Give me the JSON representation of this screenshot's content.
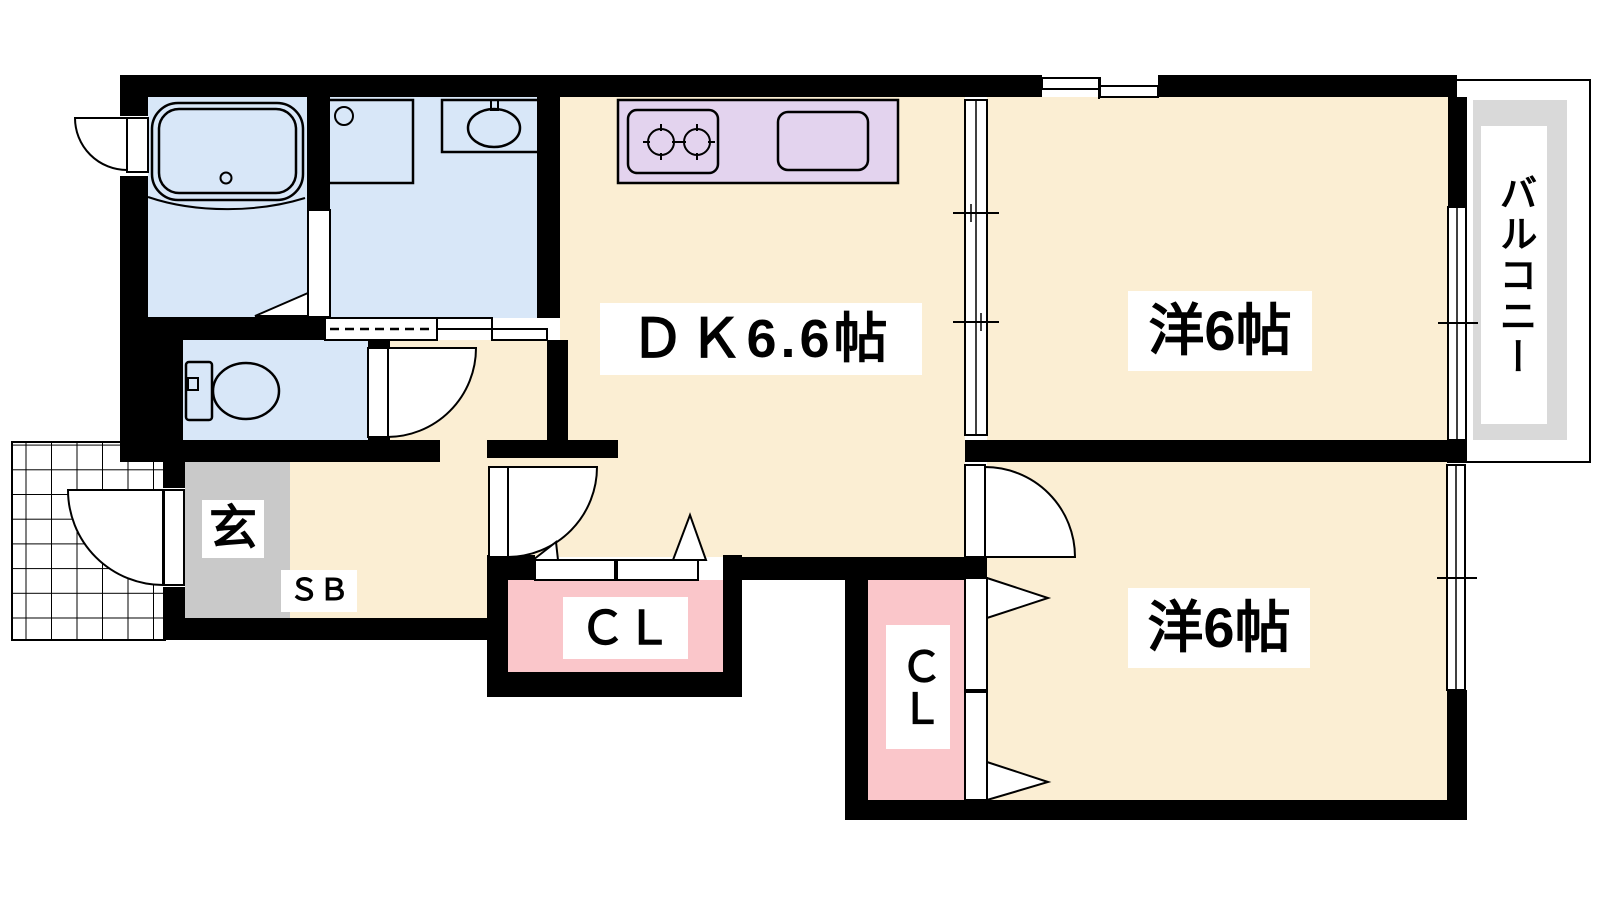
{
  "plan": {
    "type": "2DK apartment floor plan",
    "labels": {
      "dk": "ＤＫ6.6帖",
      "bedroom_upper": "洋6帖",
      "bedroom_lower": "洋6帖",
      "balcony": "バルコニー",
      "entrance": "玄",
      "shoe_box": "ＳＢ",
      "closet_hallway": "ＣＬ",
      "closet_bedroom": "ＣＬ"
    },
    "colors": {
      "wall": "#000000",
      "room_floor": "#FBEED3",
      "wet_area_floor": "#D8E7F8",
      "kitchen_counter": "#E3D3EE",
      "closet": "#FAC6CA",
      "entrance_floor": "#C9C9C9",
      "balcony_floor": "#D9D9D9",
      "line": "#000000"
    }
  }
}
